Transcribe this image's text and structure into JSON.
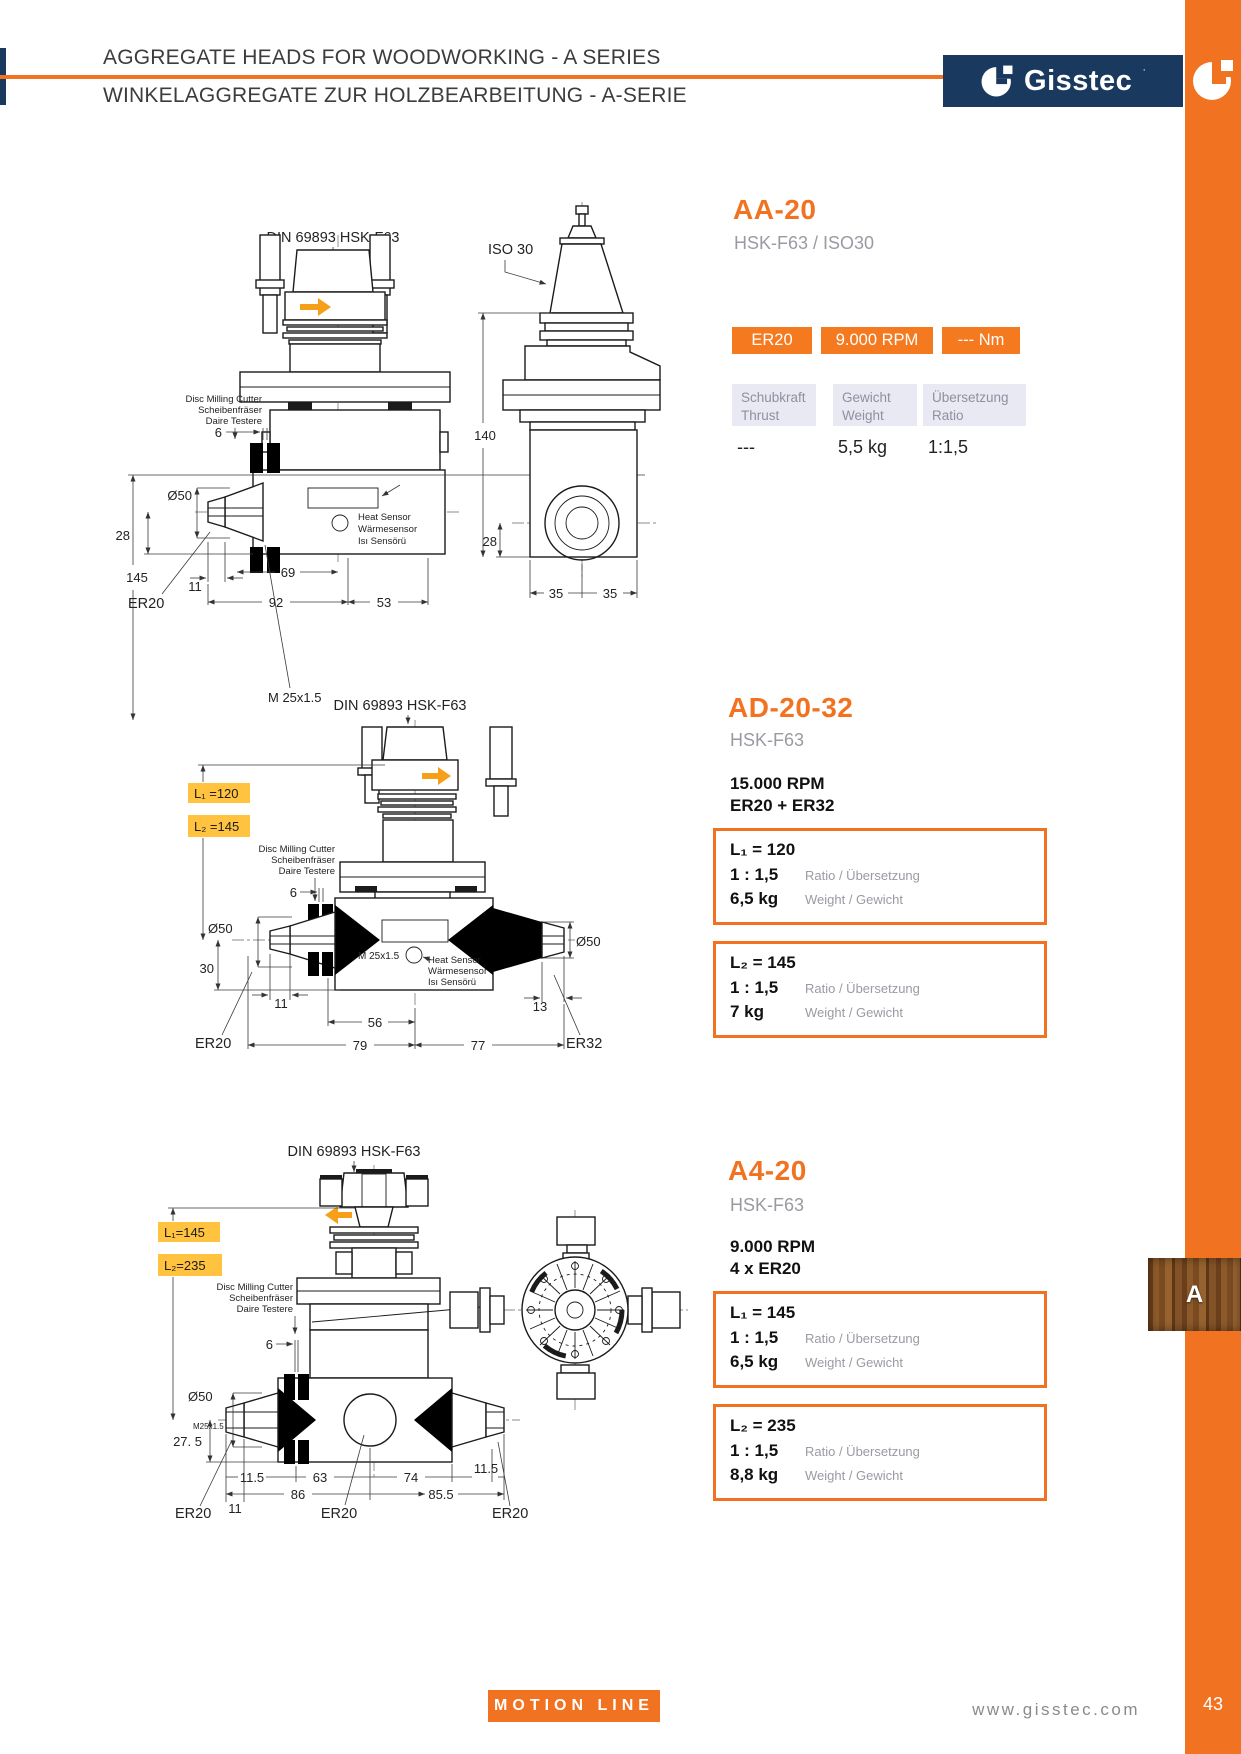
{
  "colors": {
    "orange": "#F17321",
    "navy": "#19395E",
    "highlight_yellow": "#FFC33F",
    "label_lavender": "#E9E9F3",
    "arrow_yellow": "#F5A018"
  },
  "header": {
    "title_en": "AGGREGATE HEADS FOR WOODWORKING - A SERIES",
    "title_de": "WINKELAGGREGATE ZUR HOLZBEARBEITUNG - A-SERIE",
    "brand": "Gisstec"
  },
  "footer": {
    "motion_line": "MOTION LINE",
    "website": "www.gisstec.com",
    "page_number": "43"
  },
  "side_tab": {
    "letter": "A"
  },
  "notes": {
    "spindle_standard": "DIN 69893 HSK-F63",
    "cutter": [
      "Disc Milling Cutter",
      "Scheibenfräser",
      "Daire Testere"
    ],
    "sensor": [
      "Heat Sensor",
      "Wärmesensor",
      "Isı Sensörü"
    ]
  },
  "aa20": {
    "name": "AA-20",
    "subtitle": "HSK-F63 / ISO30",
    "badges": [
      "ER20",
      "9.000 RPM",
      "--- Nm"
    ],
    "specs": [
      {
        "label_de": "Schubkraft",
        "label_en": "Thrust",
        "value": "---"
      },
      {
        "label_de": "Gewicht",
        "label_en": "Weight",
        "value": "5,5 kg"
      },
      {
        "label_de": "Übersetzung",
        "label_en": "Ratio",
        "value": "1:1,5"
      }
    ],
    "drawing": {
      "thread": "M 25x1.5",
      "collet": "ER20",
      "taper": "ISO 30",
      "dims": {
        "d145": "145",
        "d6": "6",
        "d50": "Ø50",
        "d28a": "28",
        "d11": "11",
        "d69": "69",
        "d92": "92",
        "d53": "53",
        "d140": "140",
        "d28b": "28",
        "d35a": "35",
        "d35b": "35"
      }
    }
  },
  "ad2032": {
    "name": "AD-20-32",
    "subtitle": "HSK-F63",
    "rpm": "15.000 RPM",
    "collets": "ER20 + ER32",
    "l_tags": [
      "L₁ =120",
      "L₂ =145"
    ],
    "boxes": [
      {
        "l": "L₁ = 120",
        "ratio": "1 : 1,5",
        "ratio_label": "Ratio / Übersetzung",
        "weight": "6,5 kg",
        "weight_label": "Weight / Gewicht"
      },
      {
        "l": "L₂ = 145",
        "ratio": "1 : 1,5",
        "ratio_label": "Ratio / Übersetzung",
        "weight": "7 kg",
        "weight_label": "Weight / Gewicht"
      }
    ],
    "drawing": {
      "thread": "M 25x1.5",
      "collet_left": "ER20",
      "collet_right": "ER32",
      "dims": {
        "d6": "6",
        "d50l": "Ø50",
        "d30": "30",
        "d11": "11",
        "d13": "13",
        "d56": "56",
        "d79": "79",
        "d77": "77",
        "d50r": "Ø50"
      }
    }
  },
  "a420": {
    "name": "A4-20",
    "subtitle": "HSK-F63",
    "rpm": "9.000 RPM",
    "collets": "4 x ER20",
    "l_tags": [
      "L₁=145",
      "L₂=235"
    ],
    "boxes": [
      {
        "l": "L₁ = 145",
        "ratio": "1 : 1,5",
        "ratio_label": "Ratio / Übersetzung",
        "weight": "6,5 kg",
        "weight_label": "Weight / Gewicht"
      },
      {
        "l": "L₂ = 235",
        "ratio": "1 : 1,5",
        "ratio_label": "Ratio / Übersetzung",
        "weight": "8,8 kg",
        "weight_label": "Weight / Gewicht"
      }
    ],
    "drawing": {
      "thread": "M25x1.5",
      "collets": [
        "ER20",
        "ER20",
        "ER20"
      ],
      "dims": {
        "d6": "6",
        "d50": "Ø50",
        "d275": "27. 5",
        "d115a": "11.5",
        "d63": "63",
        "d74": "74",
        "d115b": "11.5",
        "d86": "86",
        "d855": "85.5",
        "d11": "11"
      }
    }
  }
}
